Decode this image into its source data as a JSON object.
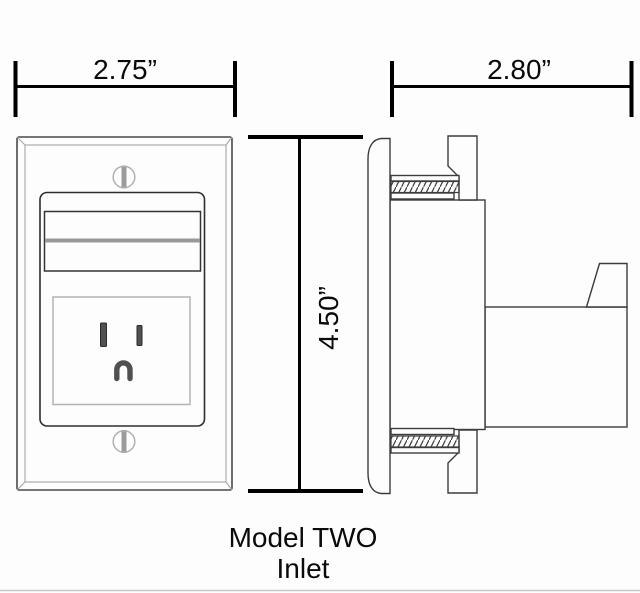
{
  "dimensions": {
    "front_width": "2.75”",
    "front_height": "4.50”",
    "side_depth": "2.80”"
  },
  "caption": {
    "line1": "Model TWO",
    "line2": "Inlet"
  },
  "colors": {
    "background": "#fdfdfd",
    "dimension": "#000000",
    "outline_dark": "#3c3c3c",
    "plate_outline": "#4a4a4a",
    "bevel_line": "#a6a6a6",
    "recess_line": "#b3b3b3",
    "slot_fill": "#4e5052",
    "gray_band": "#97999b",
    "screw_slot": "#9b9b9b",
    "screw_ring": "#b0b0b0",
    "hairline": "#c9c9cc"
  }
}
